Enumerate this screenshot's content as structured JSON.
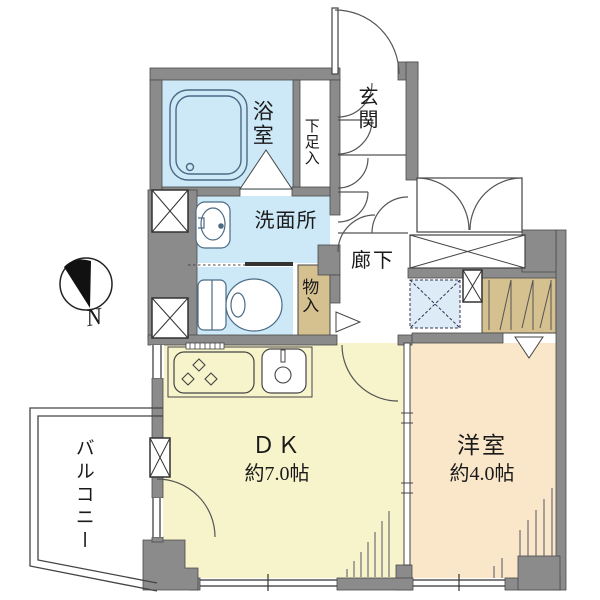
{
  "meta": {
    "type": "apartment-floor-plan",
    "language": "ja"
  },
  "compass": {
    "label": "N"
  },
  "rooms": {
    "bathroom": {
      "label": "浴室"
    },
    "shoe_cabinet": {
      "label": "下足入"
    },
    "entrance": {
      "label": "玄関"
    },
    "washroom": {
      "label": "洗面所"
    },
    "storage": {
      "label": "物入"
    },
    "hallway": {
      "label": "廊下"
    },
    "dining_kitchen": {
      "label": "ＤＫ",
      "size": "約7.0帖"
    },
    "western_room": {
      "label": "洋室",
      "size": "約4.0帖"
    },
    "balcony": {
      "label": "バルコニー"
    }
  },
  "colors": {
    "wall": "#8b8b8b",
    "water_rooms": "#cde8f6",
    "dining_kitchen": "#f7f4cb",
    "western_room": "#fae6c9",
    "closet": "#d5c08f",
    "appliance_space": "#dcebf5",
    "line": "#444444"
  }
}
